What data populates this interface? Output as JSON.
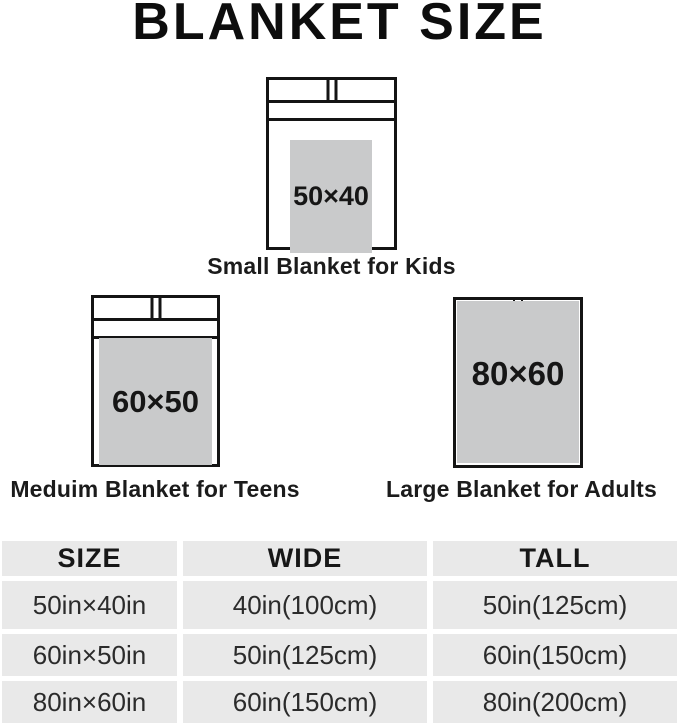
{
  "title": "BLANKET SIZE",
  "diagrams": [
    {
      "id": "small",
      "blanket_label": "50×40",
      "caption": "Small Blanket for Kids"
    },
    {
      "id": "medium",
      "blanket_label": "60×50",
      "caption": "Meduim Blanket for Teens"
    },
    {
      "id": "large",
      "blanket_label": "80×60",
      "caption": "Large Blanket for Adults"
    }
  ],
  "table": {
    "headers": [
      "SIZE",
      "WIDE",
      "TALL"
    ],
    "rows": [
      [
        "50in×40in",
        "40in(100cm)",
        "50in(125cm)"
      ],
      [
        "60in×50in",
        "50in(125cm)",
        "60in(150cm)"
      ],
      [
        "80in×60in",
        "60in(150cm)",
        "80in(200cm)"
      ]
    ]
  },
  "colors": {
    "background": "#ffffff",
    "line_black": "#141414",
    "blanket_gray": "#c9cacb",
    "table_cell_gray": "#e9e9e9"
  }
}
